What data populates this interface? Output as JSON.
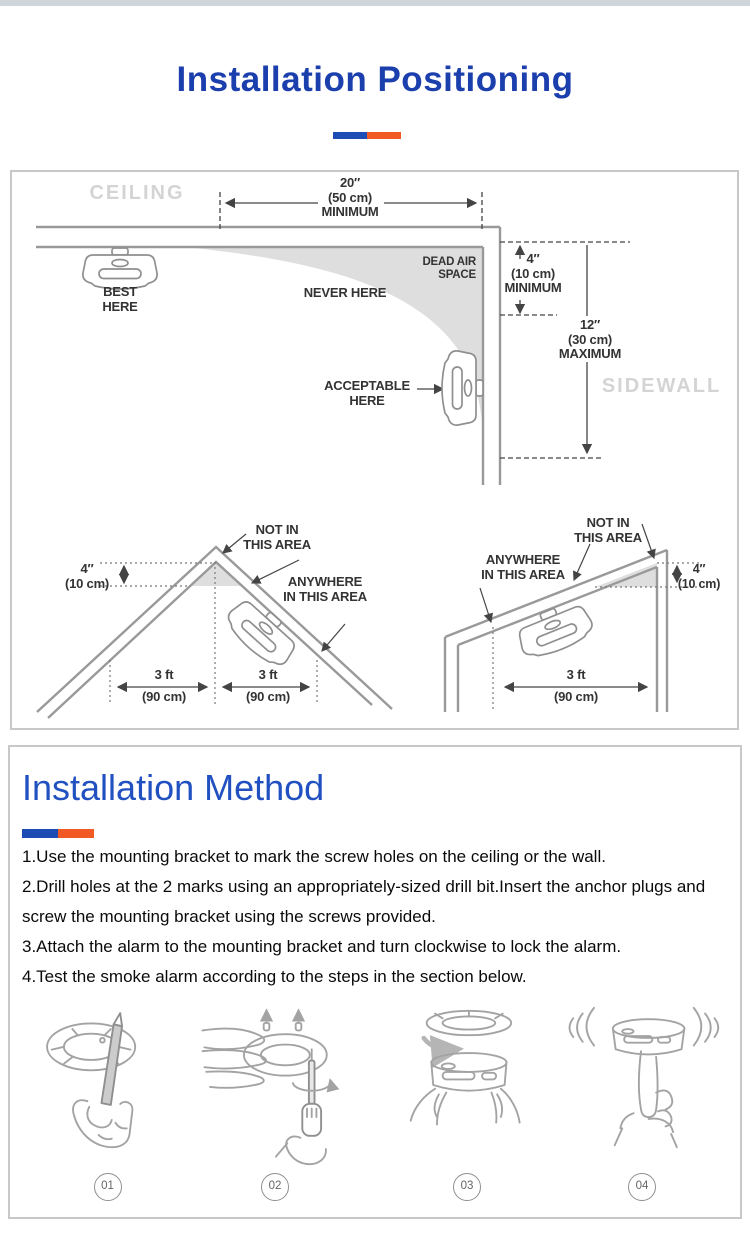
{
  "colors": {
    "title-blue": "#1c3fae",
    "method-blue": "#2151c0",
    "divider-blue": "#1d4cb5",
    "divider-orange": "#f15a24",
    "topbar": "#cfd6da"
  },
  "header": {
    "title": "Installation Positioning"
  },
  "positioning": {
    "ceiling_label": "CEILING",
    "sidewall_label": "SIDEWALL",
    "top_dim": "20″\n(50 cm)\nMINIMUM",
    "best_here": "BEST\nHERE",
    "never_here": "NEVER HERE",
    "dead_air": "DEAD AIR\nSPACE",
    "min_4": "4″\n(10 cm)\nMINIMUM",
    "max_12": "12″\n(30 cm)\nMAXIMUM",
    "acceptable": "ACCEPTABLE\nHERE",
    "peak": {
      "not_in": "NOT IN\nTHIS AREA",
      "anywhere": "ANYWHERE\nIN THIS AREA",
      "dim_4": "4″\n(10 cm)",
      "left_ft": "3 ft",
      "left_cm": "(90 cm)",
      "right_ft": "3 ft",
      "right_cm": "(90 cm)"
    },
    "sloped": {
      "not_in": "NOT IN\nTHIS AREA",
      "anywhere": "ANYWHERE\nIN THIS AREA",
      "dim_4": "4″\n(10 cm)",
      "ft": "3 ft",
      "cm": "(90 cm)"
    }
  },
  "method": {
    "title": "Installation Method",
    "steps": [
      "1.Use the mounting bracket to mark the screw holes on the ceiling or the wall.",
      "2.Drill holes at the 2 marks using an appropriately-sized drill bit.Insert the anchor plugs and screw the mounting bracket using the screws provided.",
      "3.Attach the alarm to the mounting bracket and turn clockwise to lock the alarm.",
      "4.Test the smoke alarm according to the steps in the section below."
    ],
    "figures": [
      {
        "number": "01"
      },
      {
        "number": "02"
      },
      {
        "number": "03"
      },
      {
        "number": "04"
      }
    ]
  }
}
